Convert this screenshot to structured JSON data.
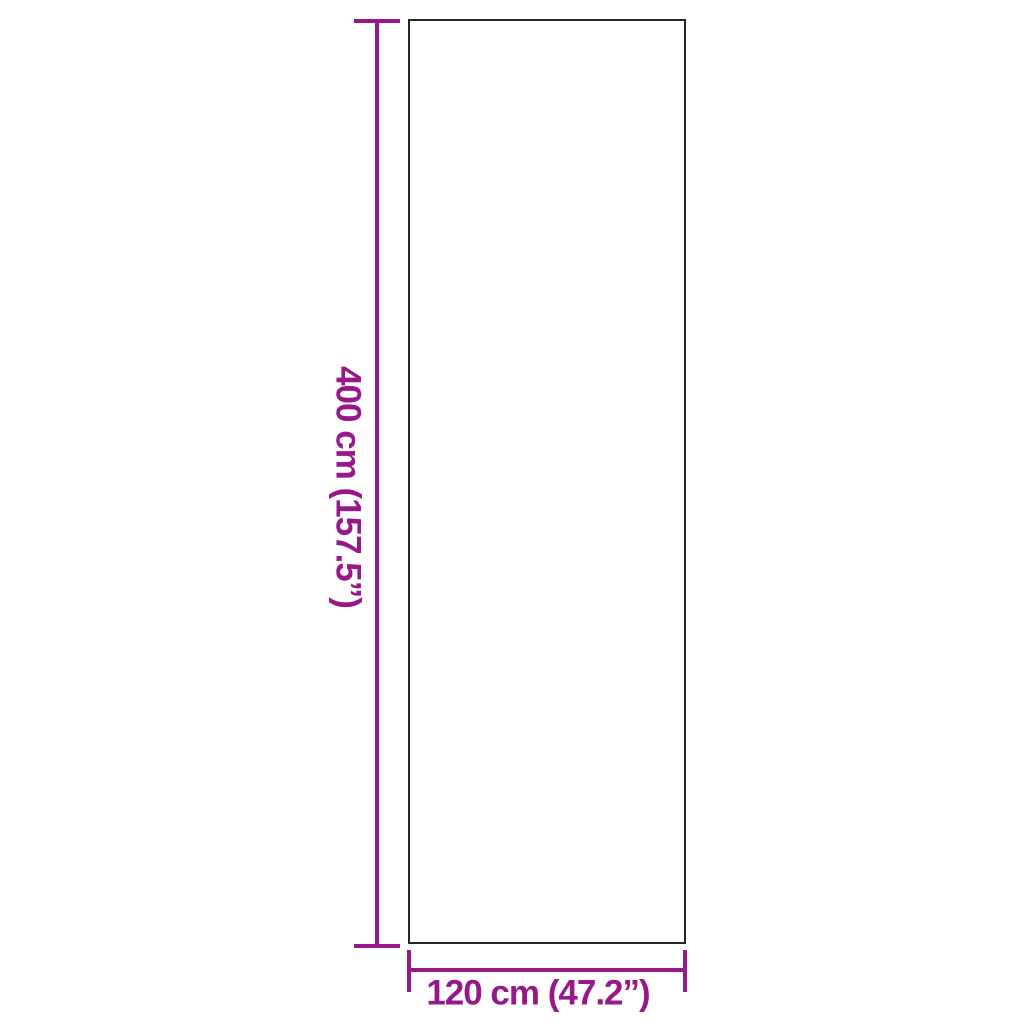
{
  "diagram": {
    "type": "product-dimensions",
    "height_label": "400 cm (157.5”)",
    "width_label": "120 cm (47.2”)"
  },
  "colors": {
    "dimension_accent": "#96188A",
    "outline": "#262626",
    "background": "#FFFFFF"
  }
}
